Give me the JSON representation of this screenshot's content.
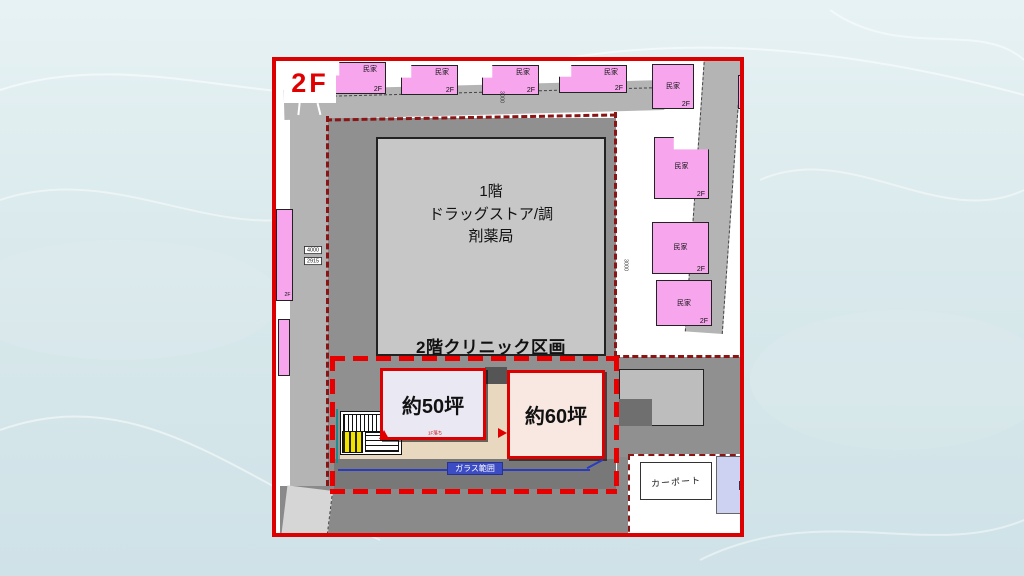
{
  "plan": {
    "floor_badge": "2F",
    "building": {
      "line1": "1階",
      "line2": "ドラッグストア/調",
      "line3": "剤薬局"
    },
    "clinic": {
      "heading": "2階クリニック区画",
      "unit_a": "約50坪",
      "unit_b": "約60坪",
      "note": "1F落ち",
      "glass_label": "ガラス範囲"
    },
    "house": {
      "label": "民家",
      "floor": "2F"
    },
    "carport": "カーポート",
    "dims": {
      "w4000": "4000",
      "w2915": "2915",
      "w3000": "3000"
    },
    "colors": {
      "plan_border": "#dd0000",
      "clinic_dash": "#e80000",
      "site_boundary": "#8b1515",
      "house_pink": "#f7a6ee",
      "road_gray": "#b4b4b4",
      "site_gray": "#909090",
      "building_gray": "#c7c7c7",
      "unit_a_fill": "#eae8f3",
      "unit_b_fill": "#f9e7e1",
      "corridor_beige": "#e9d8c0",
      "glass_blue": "#3c4cc4",
      "elevator_yellow": "#f2e200",
      "carport_lavender": "#cdd1f2"
    }
  }
}
